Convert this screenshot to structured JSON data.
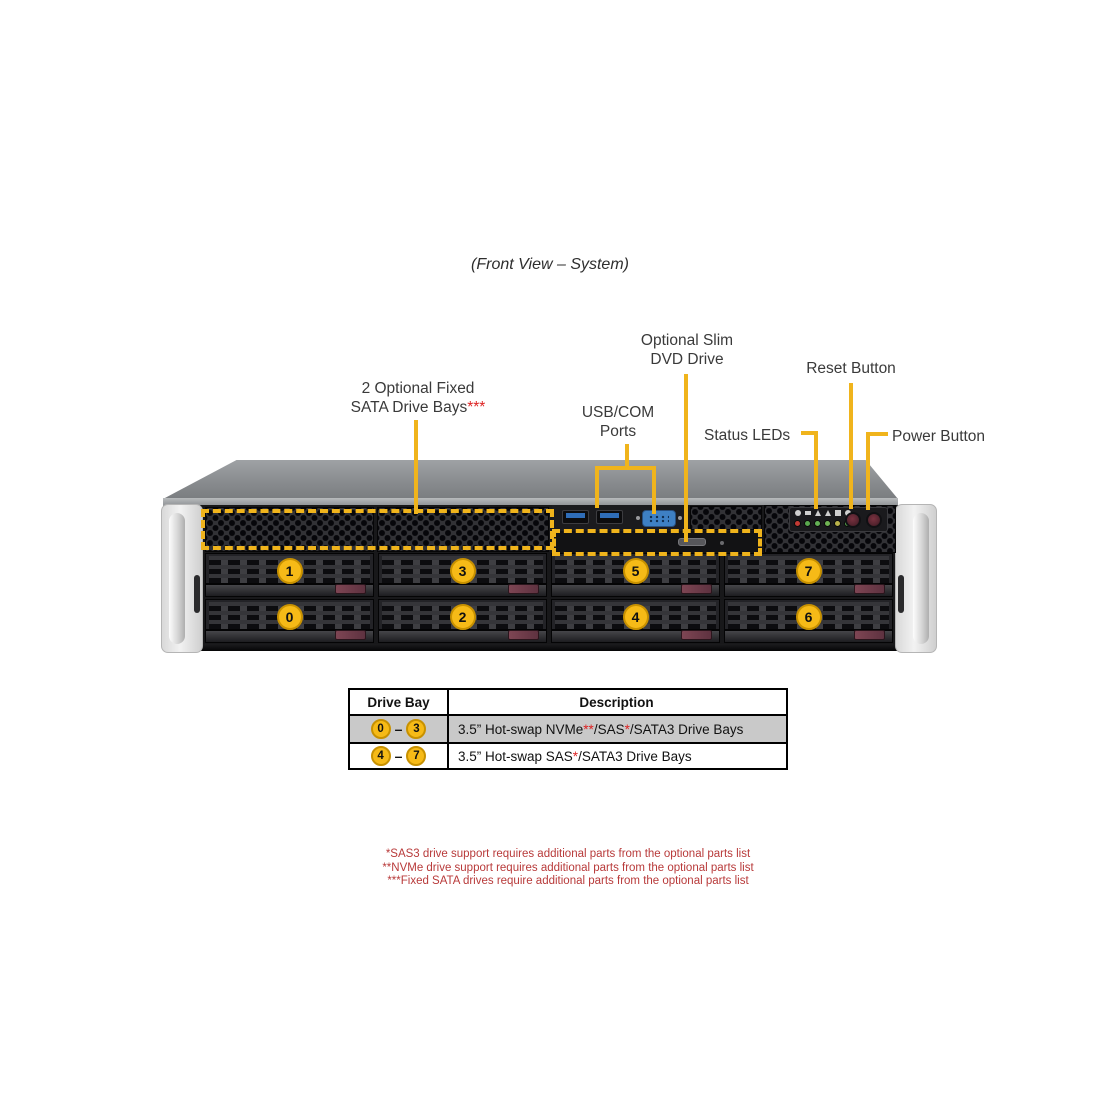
{
  "title": "(Front View – System)",
  "labels": {
    "dvd": "Optional Slim\nDVD Drive",
    "sata_main": "2 Optional Fixed\nSATA Drive Bays",
    "sata_asterisks": "***",
    "usb": "USB/COM\nPorts",
    "reset": "Reset Button",
    "status": "Status LEDs",
    "power": "Power Button"
  },
  "chassis": {
    "top_row_bays": [
      "1",
      "3",
      "5",
      "7"
    ],
    "bottom_row_bays": [
      "0",
      "2",
      "4",
      "6"
    ]
  },
  "table": {
    "headers": [
      "Drive Bay",
      "Description"
    ],
    "rows": [
      {
        "bay_start": "0",
        "bay_end": "3",
        "dash": "–",
        "desc": {
          "p1": "3.5”  Hot-swap NVMe",
          "r1": "**",
          "p2": "/SAS",
          "r2": "*",
          "p3": "/SATA3 Drive Bays"
        }
      },
      {
        "bay_start": "4",
        "bay_end": "7",
        "dash": "–",
        "desc": {
          "p1": "3.5” Hot-swap SAS",
          "r1": "*",
          "p2": "/SATA3 Drive Bays"
        }
      }
    ]
  },
  "footnotes": [
    "*SAS3 drive support requires additional parts from the optional parts list",
    "**NVMe drive support requires additional parts from the optional parts list",
    "***Fixed SATA drives require additional parts from the optional parts list"
  ],
  "colors": {
    "accent": "#f0b41c",
    "circle-fill": "#f6ba17",
    "circle-border": "#c89100",
    "label-text": "#3a3a3a",
    "asterisk-red": "#dd2222",
    "footnote-red": "#b83a3a",
    "latch-maroon": "#7e4553",
    "row-gray": "#c9c9c9"
  }
}
